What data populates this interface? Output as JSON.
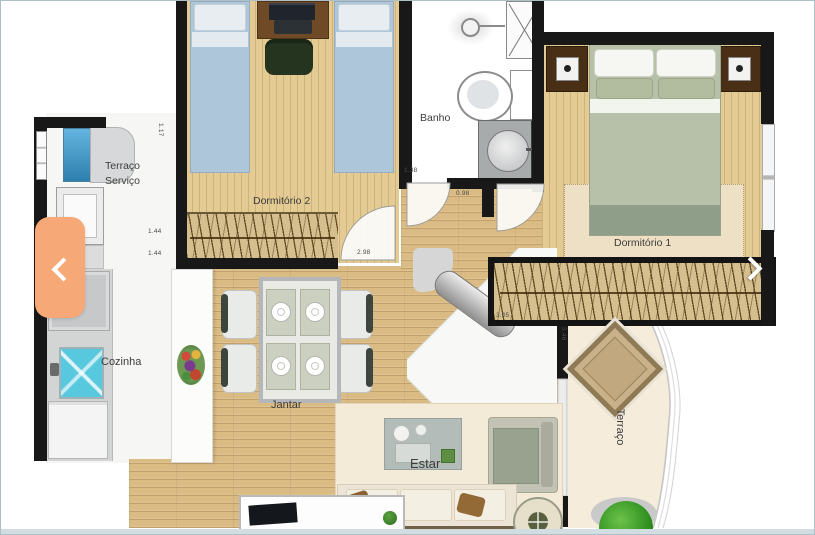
{
  "viewer": {
    "type": "apartment-floor-plan-carousel",
    "nav": {
      "prev_icon": "chevron-left",
      "next_icon": "chevron-right",
      "accent_color": "#f6a877"
    }
  },
  "rooms": {
    "terraco_servico": {
      "line1": "Terraço",
      "line2": "Serviço"
    },
    "dormitorio2": {
      "label": "Dormitório 2"
    },
    "banho": {
      "label": "Banho"
    },
    "dormitorio1": {
      "label": "Dormitório 1"
    },
    "cozinha": {
      "label": "Cozinha"
    },
    "jantar": {
      "label": "Jantar"
    },
    "estar": {
      "label": "Estar"
    },
    "terraco": {
      "label": "Terraço"
    }
  },
  "dimensions": {
    "service_top": "1.17",
    "service_left_upper": "1.44",
    "service_left_lower": "1.44",
    "banho_width": "1.38",
    "hall_door": "0.98",
    "dorm2_wardrobe": "2.98",
    "dorm1_wardrobe": "3.05",
    "terraco_depth": "3.46"
  },
  "palette": {
    "wall": "#181818",
    "wood_living": "#dabb84",
    "wood_bedroom": "#e4ca93",
    "terrace_floor": "#f6ecdc",
    "bed_blue": "#adc6d9",
    "bed_green": "#b7c1a9",
    "sink_cyan": "#57c8de",
    "accent_orange": "#f6a877",
    "plant_green": "#3f9b2f"
  }
}
